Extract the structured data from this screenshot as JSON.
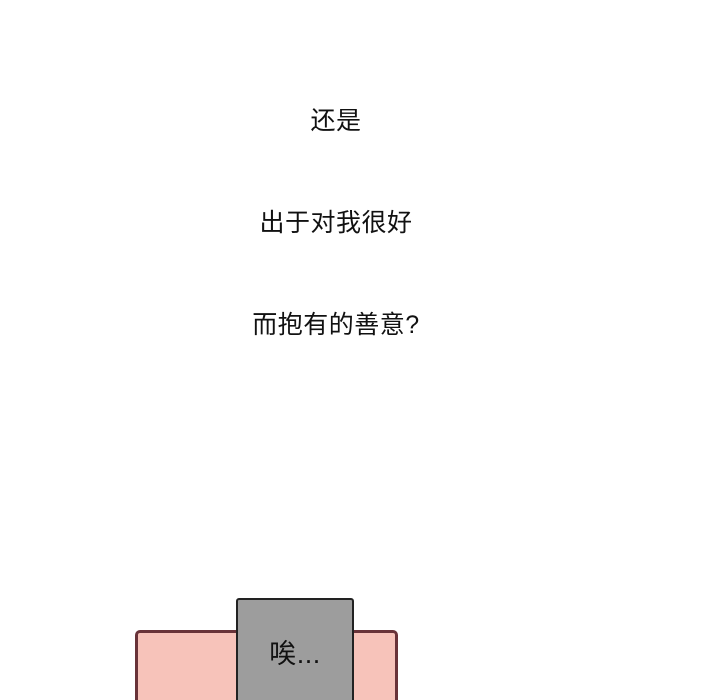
{
  "narration": {
    "lines": [
      "还是",
      "出于对我很好",
      "而抱有的善意?"
    ],
    "text_color": "#111111"
  },
  "bottom_scene": {
    "pink_panel": {
      "fill": "#f7c3ba",
      "border_color": "#693339"
    },
    "speech_box": {
      "fill": "#9d9d9d",
      "border_color": "#222222",
      "text": "唉...",
      "text_color": "#111111"
    }
  }
}
